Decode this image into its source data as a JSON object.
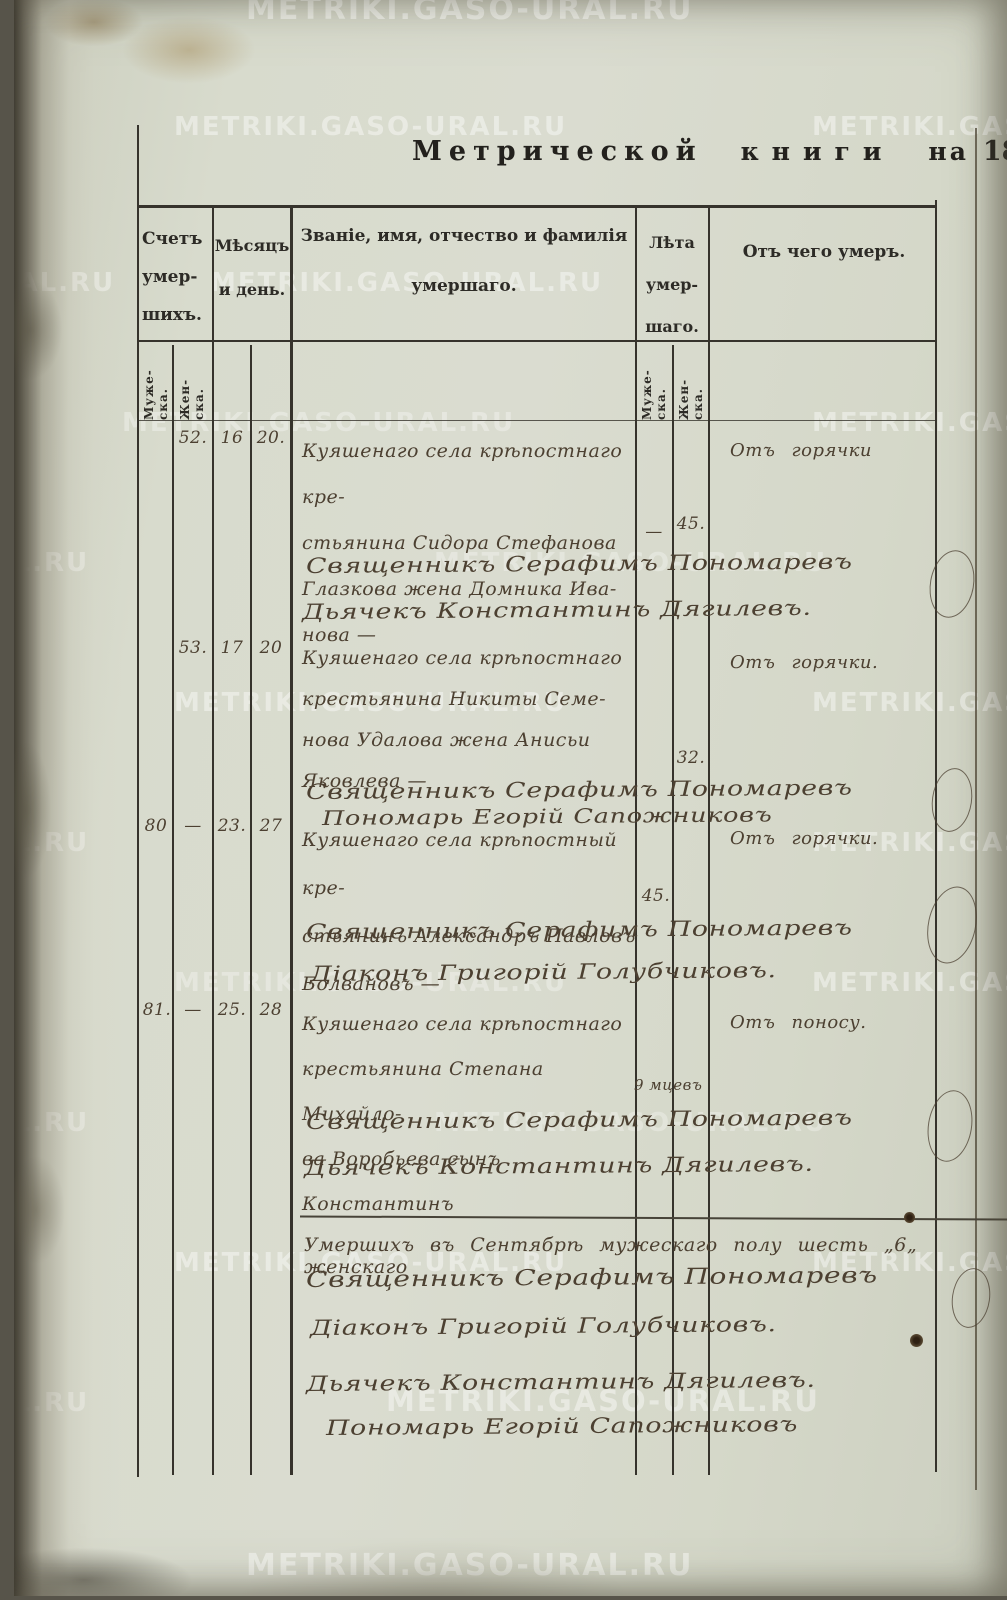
{
  "page": {
    "title_prefix": "Метрической",
    "title_book": "книги",
    "title_na": "на",
    "year_printed": "18",
    "year_hand": "43"
  },
  "watermark": {
    "text": "METRIKI.GASO-URAL.RU"
  },
  "colors": {
    "paper": "#d8dbcd",
    "ink": "#4c4031",
    "printed_ink": "#2d2b26"
  },
  "table": {
    "col_count": "Счетъ\nумер-\nшихъ.",
    "col_date": "Мѣсяцъ\nи день.",
    "col_name_line1": "Званіе, имя, отчество и фамилія",
    "col_name_line2": "умершаго.",
    "col_age": "Лѣта\nумер-\nшаго.",
    "col_cause": "Отъ чего умеръ.",
    "sub_male": "Муже-\nска.",
    "sub_female": "Жен-\nска."
  },
  "entries": [
    {
      "num_male": "",
      "num_female": "52.",
      "month": "16",
      "day": "20.",
      "desc": "Куяшенаго села крѣпостнаго кре-\nстьянина Сидора Стефанова\nГлазкова жена Домника Ива-\nнова —",
      "age_male": "—",
      "age_female": "45.",
      "cause": "Отъ горячки",
      "signatures": [
        "Священникъ Серафимъ Пономаревъ",
        "Дьячекъ Константинъ Дягилевъ."
      ]
    },
    {
      "num_male": "",
      "num_female": "53.",
      "month": "17",
      "day": "20",
      "desc": "Куяшенаго села крѣпостнаго\nкрестьянина Никиты Семе-\nнова Удалова жена Анисьи\nЯковлева —",
      "age_male": "",
      "age_female": "32.",
      "cause": "Отъ горячки.",
      "signatures": [
        "Священникъ Серафимъ Пономаревъ",
        "Пономарь Егорій Сапожниковъ"
      ]
    },
    {
      "num_male": "80",
      "num_female": "—",
      "month": "23.",
      "day": "27",
      "desc": "Куяшенаго села крѣпостный кре-\nстьянинъ Александръ Павловъ\nБолвановъ —",
      "age_male": "45.",
      "age_female": "",
      "cause": "Отъ горячки.",
      "signatures": [
        "Священникъ Серафимъ Пономаревъ",
        "Діаконъ Григорій Голубчиковъ."
      ]
    },
    {
      "num_male": "81.",
      "num_female": "—",
      "month": "25.",
      "day": "28",
      "desc": "Куяшенаго села крѣпостнаго\nкрестьянина Степана Михайло-\nва Воробьева сынъ Константинъ",
      "age_male": "9 мцевъ",
      "age_female": "",
      "cause": "Отъ поносу.",
      "signatures": [
        "Священникъ Серафимъ Пономаревъ",
        "Дьячекъ Константинъ Дягилевъ."
      ]
    }
  ],
  "summary": {
    "line": "Умершихъ въ Сентябрѣ мужескаго полу шесть „6„ женскаго",
    "signatures": [
      "Священникъ Серафимъ Пономаревъ",
      "Діаконъ Григорій Голубчиковъ.",
      "Дьячекъ Константинъ Дягилевъ.",
      "Пономарь Егорій Сапожниковъ"
    ]
  }
}
